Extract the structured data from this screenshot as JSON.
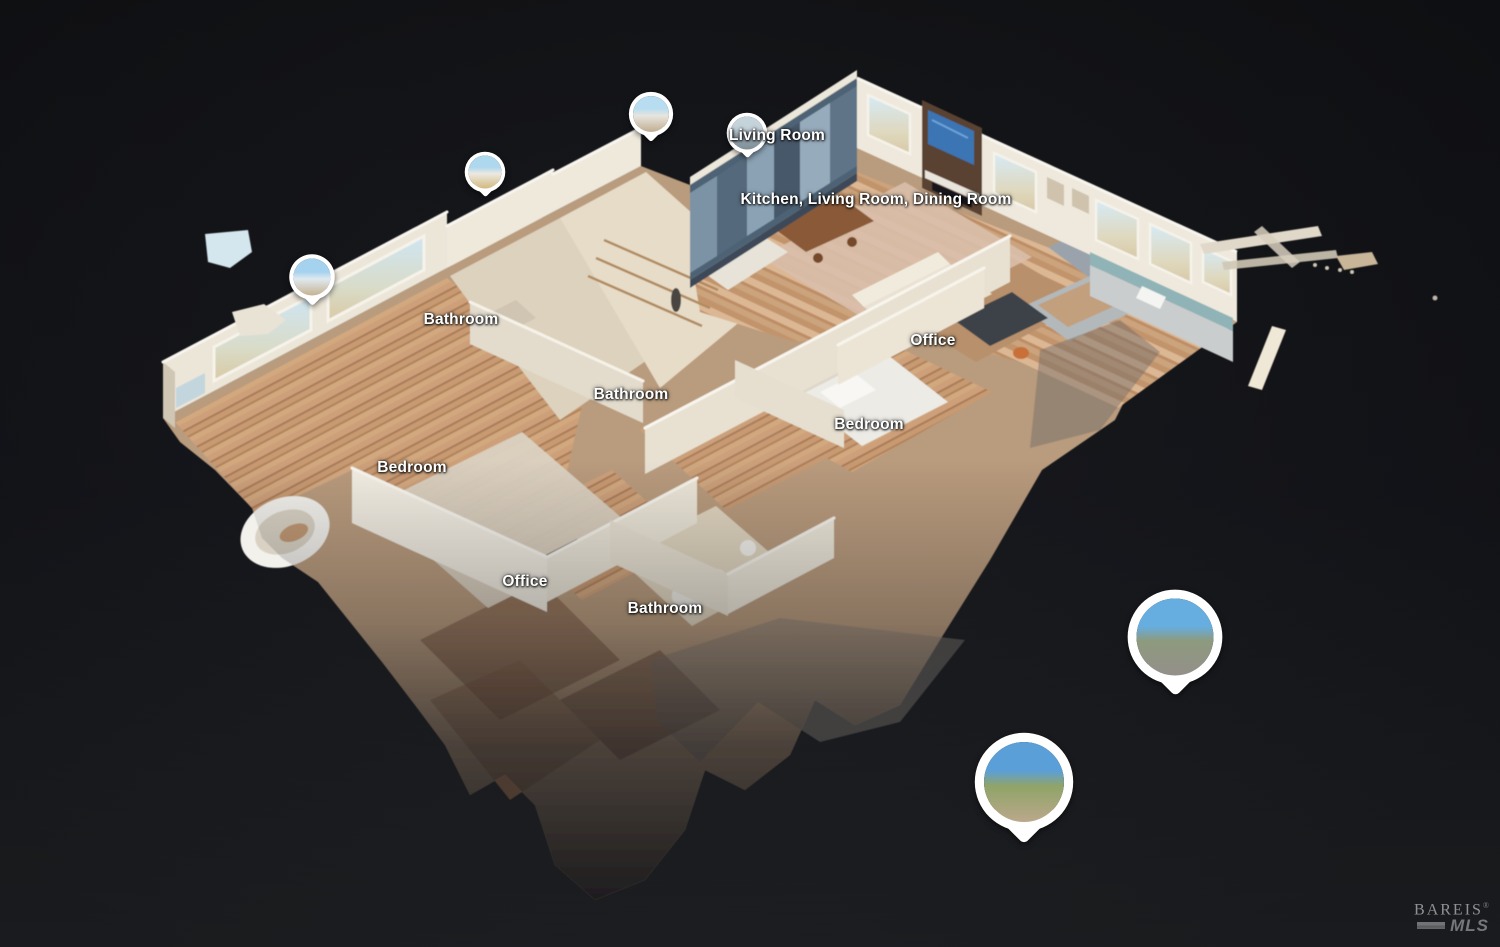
{
  "scene": {
    "description": "3D dollhouse cutaway view of a single-story home in a virtual tour viewer",
    "background_top": "#101114",
    "background_bottom": "#1d1f22"
  },
  "room_labels": [
    {
      "text": "Living Room",
      "x": 777,
      "y": 136
    },
    {
      "text": "Kitchen, Living Room, Dining Room",
      "x": 876,
      "y": 200
    },
    {
      "text": "Bathroom",
      "x": 461,
      "y": 320
    },
    {
      "text": "Bathroom",
      "x": 631,
      "y": 395
    },
    {
      "text": "Office",
      "x": 933,
      "y": 341
    },
    {
      "text": "Bedroom",
      "x": 869,
      "y": 425
    },
    {
      "text": "Bedroom",
      "x": 412,
      "y": 468
    },
    {
      "text": "Office",
      "x": 525,
      "y": 582
    },
    {
      "text": "Bathroom",
      "x": 665,
      "y": 609
    }
  ],
  "pins": [
    {
      "name": "pin-exterior-1",
      "x": 651,
      "y": 114,
      "d": "36px",
      "var_sky": "#b9ddf0",
      "var_mid": "#e8e5de",
      "var_ground": "#c0ad90"
    },
    {
      "name": "pin-living-room",
      "x": 747,
      "y": 133,
      "d": "33px",
      "var_sky": "#c5d3da",
      "var_mid": "#9fb0ba",
      "var_ground": "#7e8d96"
    },
    {
      "name": "pin-exterior-2",
      "x": 485,
      "y": 172,
      "d": "33px",
      "var_sky": "#aed8ee",
      "var_mid": "#ece9e1",
      "var_ground": "#d2b97e"
    },
    {
      "name": "pin-exterior-3",
      "x": 312,
      "y": 277,
      "d": "37px",
      "var_sky": "#a5d2ee",
      "var_mid": "#dfe9f0",
      "var_ground": "#c6b292"
    },
    {
      "name": "pin-patio-1",
      "x": 1175,
      "y": 637,
      "d": "77px",
      "var_sky": "#66aee0",
      "var_mid": "#8d9a7e",
      "var_ground": "#94908a"
    },
    {
      "name": "pin-patio-2",
      "x": 1024,
      "y": 782,
      "d": "80px",
      "var_sky": "#5b9fd8",
      "var_mid": "#90a468",
      "var_ground": "#bba88c"
    }
  ],
  "watermark": {
    "brand": "BAREIS",
    "registered": "®",
    "sub": "MLS"
  }
}
